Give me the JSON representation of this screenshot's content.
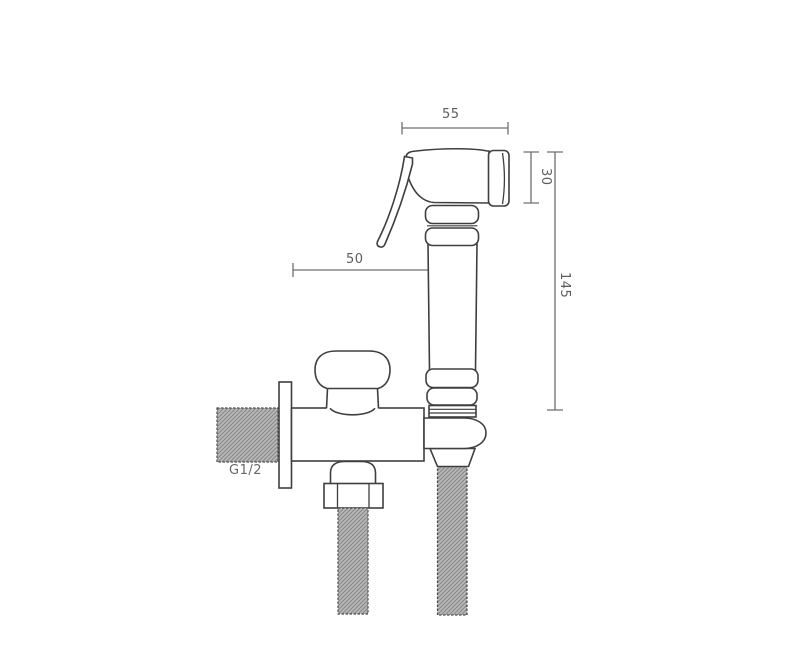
{
  "image": {
    "title": "Bidet sprayer with angle valve - dimensioned technical drawing"
  },
  "drawing": {
    "dimensions": {
      "head_width": "55",
      "head_height": "30",
      "sprayer_height": "145",
      "offset": "50"
    },
    "thread_label": "G1/2",
    "colors": {
      "outline": "#3f3f3f",
      "dimension_line": "#6f6f6f",
      "label_text": "#5d5d5d",
      "hatch_fill": "#b9b9b9",
      "hatch_stroke": "#878787",
      "background": "#ffffff"
    }
  }
}
